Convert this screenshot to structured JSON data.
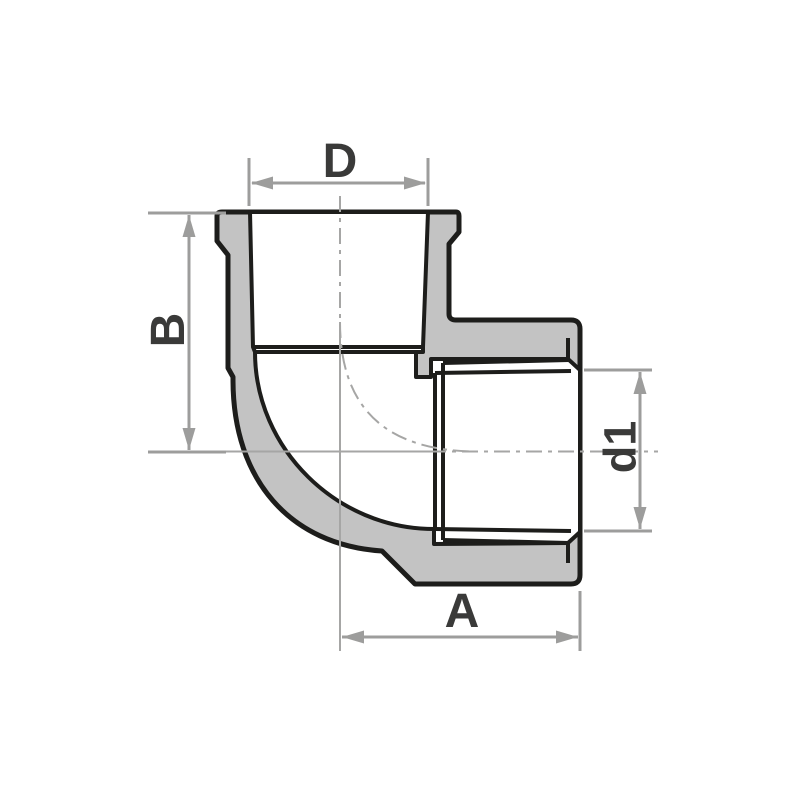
{
  "drawing": {
    "dimensions": {
      "top_width_label": "D",
      "left_height_label": "B",
      "bottom_length_label": "A",
      "right_bore_label": "d1"
    }
  },
  "colors": {
    "background": "#ffffff",
    "body_fill": "#c3c3c3",
    "outline": "#1d1d1b",
    "dimension": "#9d9d9c",
    "label": "#3a3a39"
  }
}
